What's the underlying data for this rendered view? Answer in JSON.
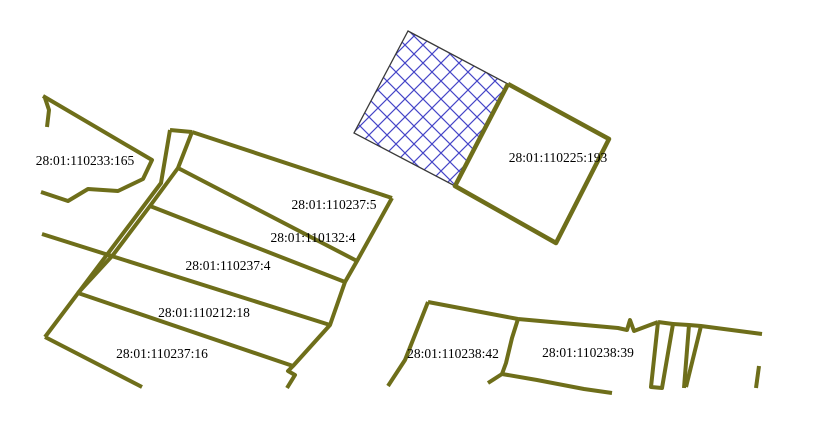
{
  "map": {
    "width": 819,
    "height": 439,
    "background": "#ffffff",
    "colors": {
      "boundary": "#6e6e1a",
      "selected_outline": "#3a3a3a",
      "selected_hatch": "#4646c8",
      "label": "#000000"
    },
    "label_font_size": 13.5,
    "parcel_labels": [
      {
        "id": "28:01:110233:165",
        "x": 85,
        "y": 165
      },
      {
        "id": "28:01:110237:5",
        "x": 334,
        "y": 209
      },
      {
        "id": "28:01:110132:4",
        "x": 313,
        "y": 242
      },
      {
        "id": "28:01:110237:4",
        "x": 228,
        "y": 270
      },
      {
        "id": "28:01:110212:18",
        "x": 204,
        "y": 317
      },
      {
        "id": "28:01:110237:16",
        "x": 162,
        "y": 358
      },
      {
        "id": "28:01:110225:193",
        "x": 558,
        "y": 162
      },
      {
        "id": "28:01:110238:42",
        "x": 453,
        "y": 358
      },
      {
        "id": "28:01:110238:39",
        "x": 588,
        "y": 357
      }
    ],
    "selected_parcel": {
      "name": "hatched-selected-parcel",
      "points": "408,31 508,84 455,186 354,133",
      "hatch_spacing": 18,
      "hatch_line_width": 1.2,
      "outline_width": 1.3
    },
    "boundaries": [
      {
        "name": "parcel-110233-165-outline",
        "points": "43,96 152,160 143,179 118,191 88,189 68,201 41,192",
        "w": 4
      },
      {
        "name": "parcel-110233-165-west-stub",
        "points": "45,98 49,110 47,127",
        "w": 4
      },
      {
        "name": "block-outer-left-edge",
        "points": "170,130 161,183 45,337",
        "w": 4
      },
      {
        "name": "sliver-top-edge",
        "points": "170,130 192,132",
        "w": 4
      },
      {
        "name": "block-inner-left-edge",
        "points": "192,132 178,168 150,206 113,255 78,293",
        "w": 4
      },
      {
        "name": "strip-block-north-edge",
        "points": "192,132 392,198",
        "w": 4
      },
      {
        "name": "strip-block-right-edge",
        "points": "392,198 357,261 345,282 330,325 293,366 288,371 295,375 287,388",
        "w": 4
      },
      {
        "name": "strip-boundary-237-5-132-4",
        "points": "178,168 357,261",
        "w": 4
      },
      {
        "name": "strip-boundary-132-4-237-4",
        "points": "150,206 345,282",
        "w": 4
      },
      {
        "name": "strip-boundary-237-4-212-18",
        "points": "42,234 330,325",
        "w": 4
      },
      {
        "name": "strip-boundary-212-18-237-16",
        "points": "78,293 293,366",
        "w": 4
      },
      {
        "name": "block-south-dangling-edge",
        "points": "45,337 142,387",
        "w": 4
      },
      {
        "name": "parcel-110225-193-outline",
        "points": "508,84 609,139 556,243 455,186 508,84",
        "w": 4.5
      },
      {
        "name": "parcel-110238-42-west-edge",
        "points": "428,302 405,360 388,386",
        "w": 4
      },
      {
        "name": "parcel-110238-42-north-edge",
        "points": "428,302 518,319",
        "w": 4
      },
      {
        "name": "parcel-divider-42-39",
        "points": "518,319 512,338 506,363 502,374",
        "w": 4
      },
      {
        "name": "parcel-110238-39-north-edge",
        "points": "518,319 618,328 627,330 630,320 634,331 658,322",
        "w": 4
      },
      {
        "name": "narrow-parcel-1-outline",
        "points": "658,322 673,324 662,388 651,387 658,322",
        "w": 4
      },
      {
        "name": "east-north-edge",
        "points": "673,324 689,325 701,326 762,334",
        "w": 4
      },
      {
        "name": "narrow-parcel-2-west-edge",
        "points": "689,325 684,388",
        "w": 4
      },
      {
        "name": "narrow-parcel-2-slant-edge",
        "points": "701,326 686,387",
        "w": 4
      },
      {
        "name": "far-east-dangling-edge",
        "points": "759,366 756,388",
        "w": 4
      },
      {
        "name": "south-edge-238-block",
        "points": "488,383 502,374 537,380 584,389 612,393",
        "w": 4
      }
    ]
  }
}
